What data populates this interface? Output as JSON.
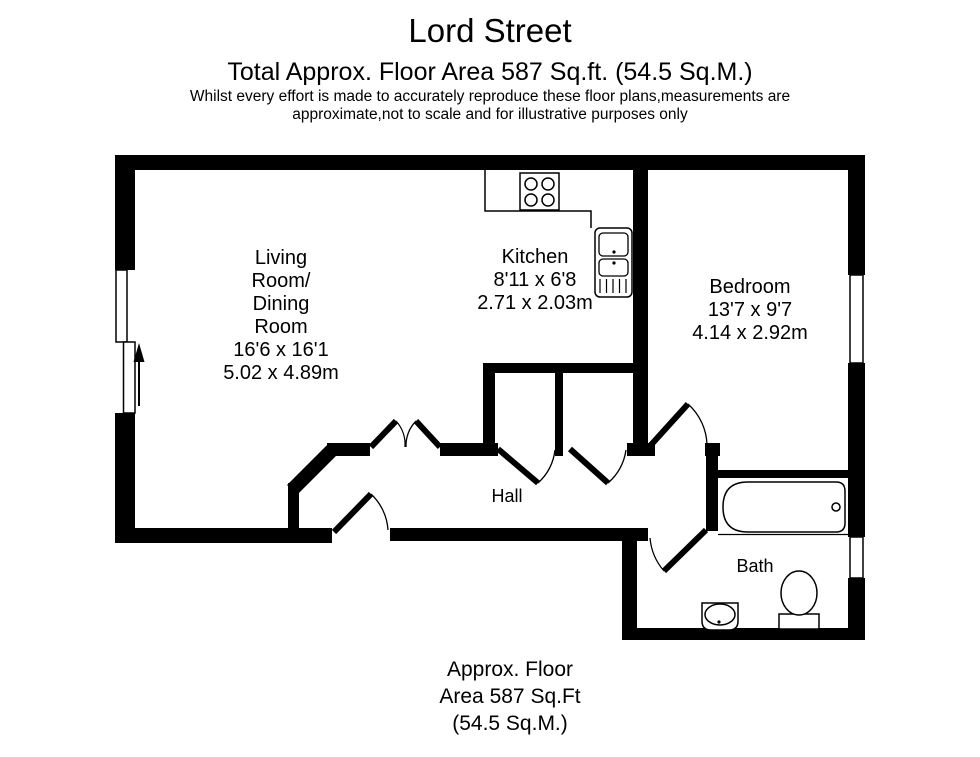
{
  "header": {
    "title": "Lord Street",
    "subtitle": "Total Approx. Floor Area 587 Sq.ft. (54.5 Sq.M.)",
    "disclaimer_line1": "Whilst every effort is made to accurately reproduce these floor plans,measurements are",
    "disclaimer_line2": "approximate,not to scale and for illustrative purposes only"
  },
  "rooms": {
    "living": {
      "name_line1": "Living",
      "name_line2": "Room/",
      "name_line3": "Dining",
      "name_line4": "Room",
      "size_imperial": "16'6 x 16'1",
      "size_metric": "5.02 x 4.89m"
    },
    "kitchen": {
      "name": "Kitchen",
      "size_imperial": "8'11 x 6'8",
      "size_metric": "2.71 x 2.03m"
    },
    "bedroom": {
      "name": "Bedroom",
      "size_imperial": "13'7 x 9'7",
      "size_metric": "4.14 x 2.92m"
    },
    "hall": {
      "name": "Hall"
    },
    "bath": {
      "name": "Bath"
    }
  },
  "footer": {
    "line1": "Approx. Floor",
    "line2": "Area 587 Sq.Ft",
    "line3": "(54.5 Sq.M.)"
  },
  "colors": {
    "wall": "#000000",
    "background": "#ffffff",
    "text": "#000000"
  }
}
